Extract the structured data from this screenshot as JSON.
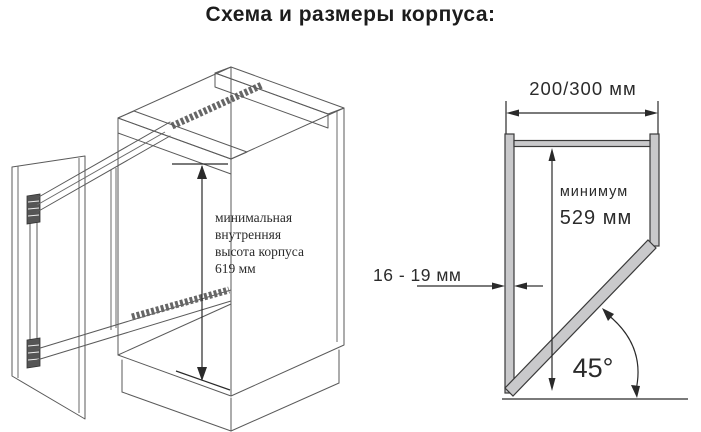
{
  "title": "Схема и размеры корпуса:",
  "left_figure": {
    "annotation_lines": [
      "минимальная",
      "внутренняя",
      "высота корпуса",
      "619 мм"
    ]
  },
  "right_figure": {
    "width_dimension": "200/300 мм",
    "minimum_label": "минимум",
    "minimum_value": "529 мм",
    "thickness_dimension": "16 - 19 мм",
    "angle_value": "45°"
  },
  "colors": {
    "panel_fill": "#c9c9cb",
    "wireframe_line": "#5a5a5a",
    "dimension_line": "#2a2a2a",
    "text": "#2b2b2b"
  }
}
